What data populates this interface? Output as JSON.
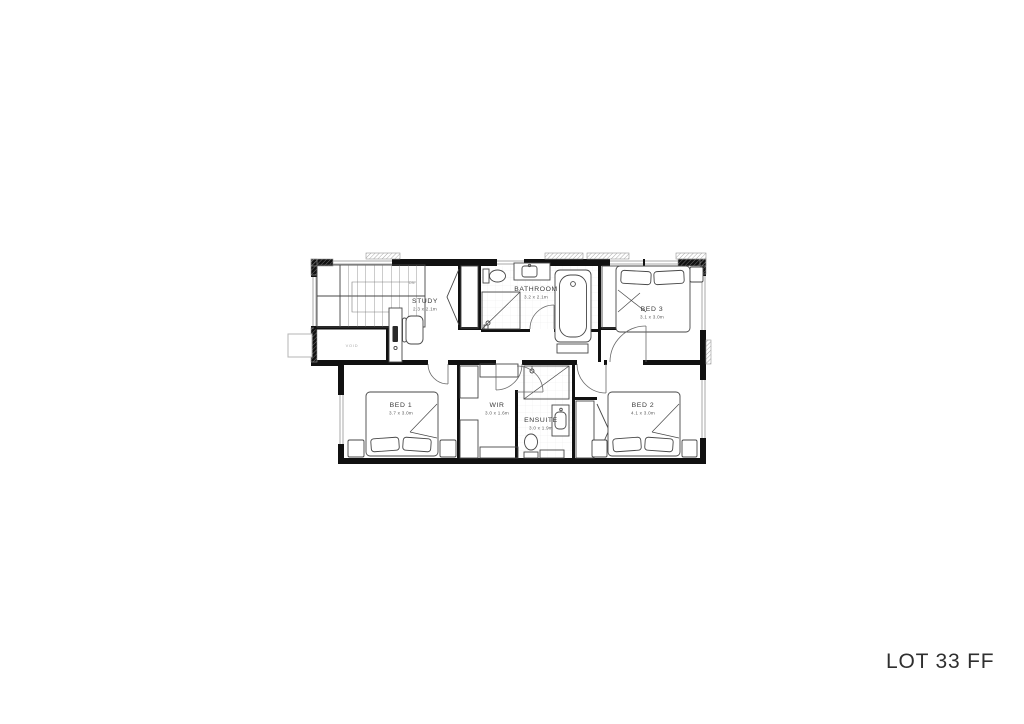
{
  "title": "LOT 33 FF",
  "rooms": {
    "study": {
      "name": "STUDY",
      "dims": "2.3 x 2.1m"
    },
    "bathroom": {
      "name": "BATHROOM",
      "dims": "3.2 x 2.1m"
    },
    "bed3": {
      "name": "BED 3",
      "dims": "3.1 x 3.0m"
    },
    "bed1": {
      "name": "BED 1",
      "dims": "3.7 x 3.0m"
    },
    "wir": {
      "name": "WIR",
      "dims": "3.0 x 1.6m"
    },
    "ensuite": {
      "name": "ENSUITE",
      "dims": "3.0 x 1.9m"
    },
    "bed2": {
      "name": "BED 2",
      "dims": "4.1 x 3.0m"
    }
  },
  "annotations": {
    "void_label": "VOID",
    "stair_direction": "DN"
  },
  "colors": {
    "wall": "#111111",
    "furniture_line": "#474747",
    "window_line": "#a8a8a8",
    "hatch_line": "#8c8c8c",
    "room_text": "#3a3a3a",
    "dim_text": "#5a5a5a",
    "muted_text": "#a6a6a6",
    "title_text": "#2f2f2f",
    "background": "#ffffff"
  }
}
